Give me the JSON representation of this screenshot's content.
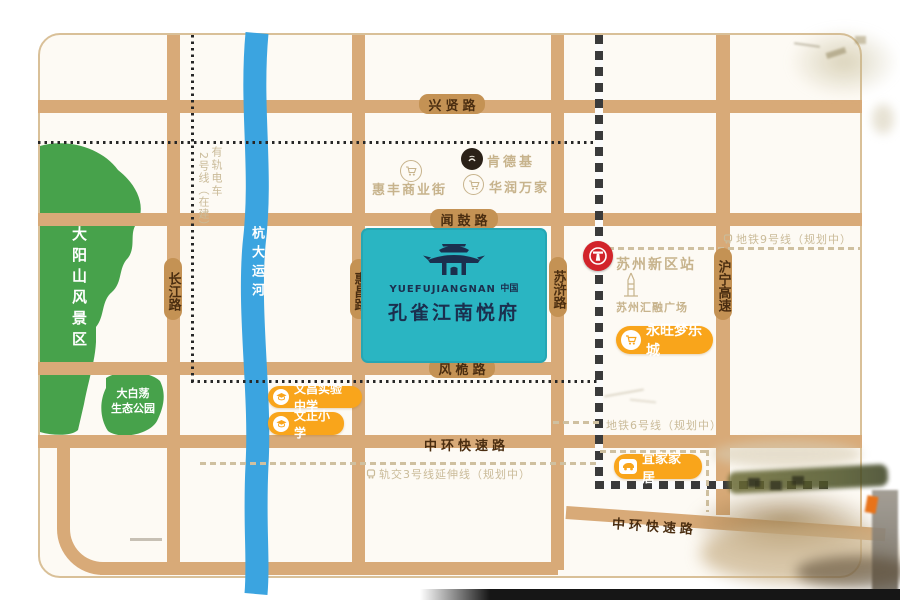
{
  "project": {
    "name_cn": "孔雀江南悦府",
    "name_en": "YUEFUJIANGNAN",
    "seal": "中国"
  },
  "roads": {
    "xingxian": "兴贤路",
    "wengu": "闻鼓路",
    "fengwei": "风桅路",
    "zhonghuan": "中环快速路",
    "zhonghuan_se": "中环快速路",
    "changjiang": "长江路",
    "huichang": "惠昌路",
    "suhu": "苏浒路",
    "huning": "沪宁高速"
  },
  "river": {
    "name": "杭大运河"
  },
  "parks": {
    "dayangshan": "大阳山风景区",
    "dabaidang_line1": "大白荡",
    "dabaidang_line2": "生态公园"
  },
  "transit": {
    "tram_col1": "有轨电车",
    "tram_col2": "2号线（在建）",
    "metro9": "地铁9号线（规划中）",
    "metro6": "地铁6号线（规划中）",
    "metro3ext": "轨交3号线延伸线（规划中）"
  },
  "pois": {
    "kfc": "肯德基",
    "huifeng": "惠丰商业街",
    "huarun": "华润万家",
    "station": "苏州新区站",
    "huirong": "苏州汇融广场",
    "aeon": "永旺梦乐城",
    "ikea": "宜家家居",
    "wenchang_school": "文昌实验中学",
    "wenzheng_school": "文正小学"
  },
  "colors": {
    "road": "#d8aa78",
    "road_badge": "#c49254",
    "road_text": "#4a2d10",
    "river": "#3ba4e0",
    "park_green": "#47a24b",
    "project_teal": "#2ab5c2",
    "project_navy": "#1b2f4e",
    "poi_orange": "#f9a51b",
    "station_red": "#d2232a",
    "muted_tan": "#c7b38c"
  }
}
